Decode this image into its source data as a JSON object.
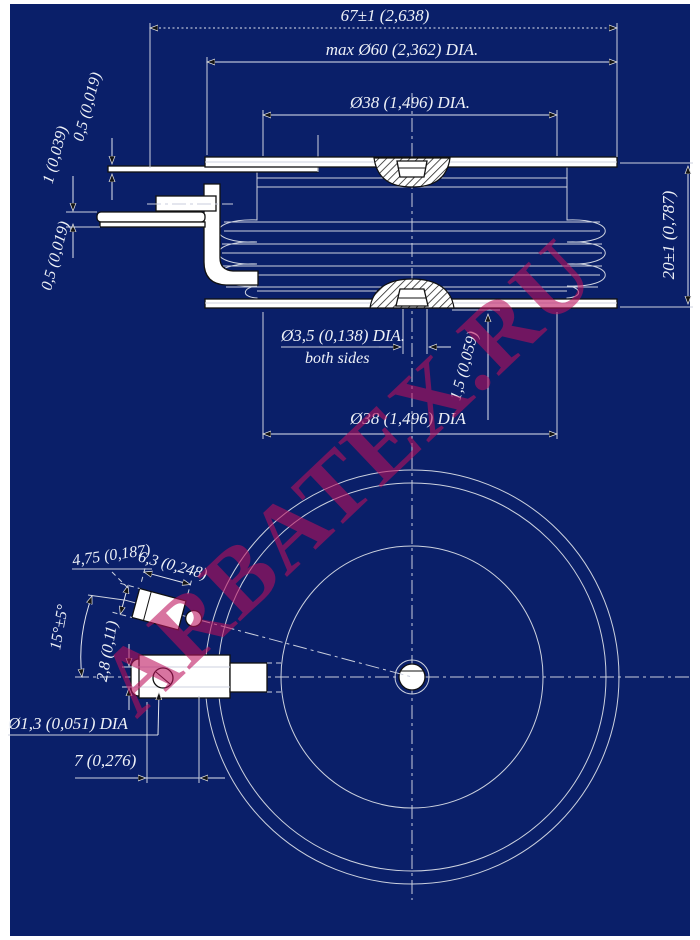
{
  "colors": {
    "background": "#0a1f69",
    "page": "#ffffff",
    "line": "#d8dbe4",
    "shape_fill": "#ffffff",
    "shape_stroke": "#111111",
    "text": "#eef1f7",
    "watermark": "rgba(187,16,92,0.58)"
  },
  "watermark": {
    "text": "ARBATEX.RU"
  },
  "side_view": {
    "dims": {
      "overall_width": "67±1 (2,638)",
      "flange_dia": "max Ø60 (2,362) DIA.",
      "contact_dia_top": "Ø38 (1,496) DIA.",
      "lead_thickness_top": "0,5 (0,019)",
      "lead_thickness_mid": "1 (0,039)",
      "lead_thickness_bottom": "0,5 (0,019)",
      "height": "20±1 (0,787)",
      "center_hole_dia": "Ø3,5 (0,138) DIA.",
      "center_hole_note": "both sides",
      "boss_height": "1,5 (0,059)",
      "contact_dia_bottom": "Ø38 (1,496) DIA"
    }
  },
  "bottom_view": {
    "dims": {
      "terminal_width": "4,75 (0,187)",
      "terminal_length": "6,3 (0,248)",
      "terminal_angle": "15°±5°",
      "terminal_offset": "2,8 (0,11)",
      "terminal_hole_dia": "Ø1,3 (0,051) DIA",
      "hole_spacing": "7 (0,276)"
    }
  }
}
